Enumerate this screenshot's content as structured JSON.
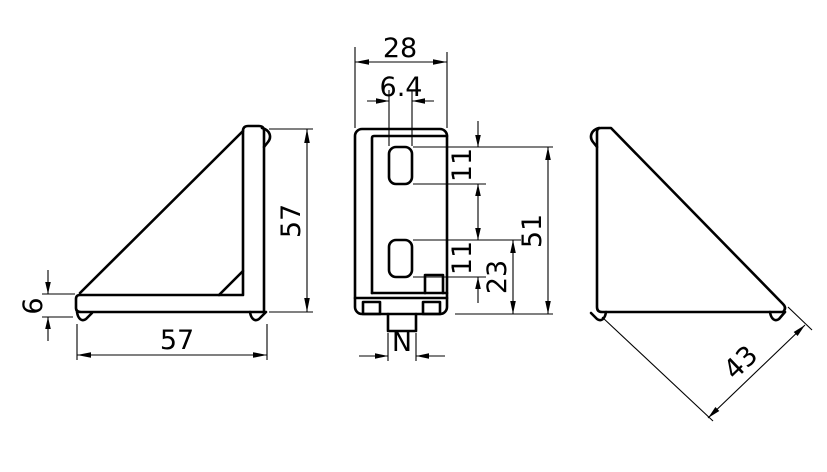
{
  "drawing": {
    "background": "#ffffff",
    "line_color": "#000000",
    "views": {
      "left_side": {
        "dim_height": "57",
        "dim_width": "57",
        "dim_thickness": "6"
      },
      "front": {
        "dim_width": "28",
        "dim_slot_width": "6.4",
        "dim_slot1_height": "11",
        "dim_slot2_height": "11",
        "dim_slot2_to_base": "23",
        "dim_height": "51",
        "dim_tab_width": "N"
      },
      "right_side": {
        "dim_diagonal": "43"
      }
    }
  }
}
